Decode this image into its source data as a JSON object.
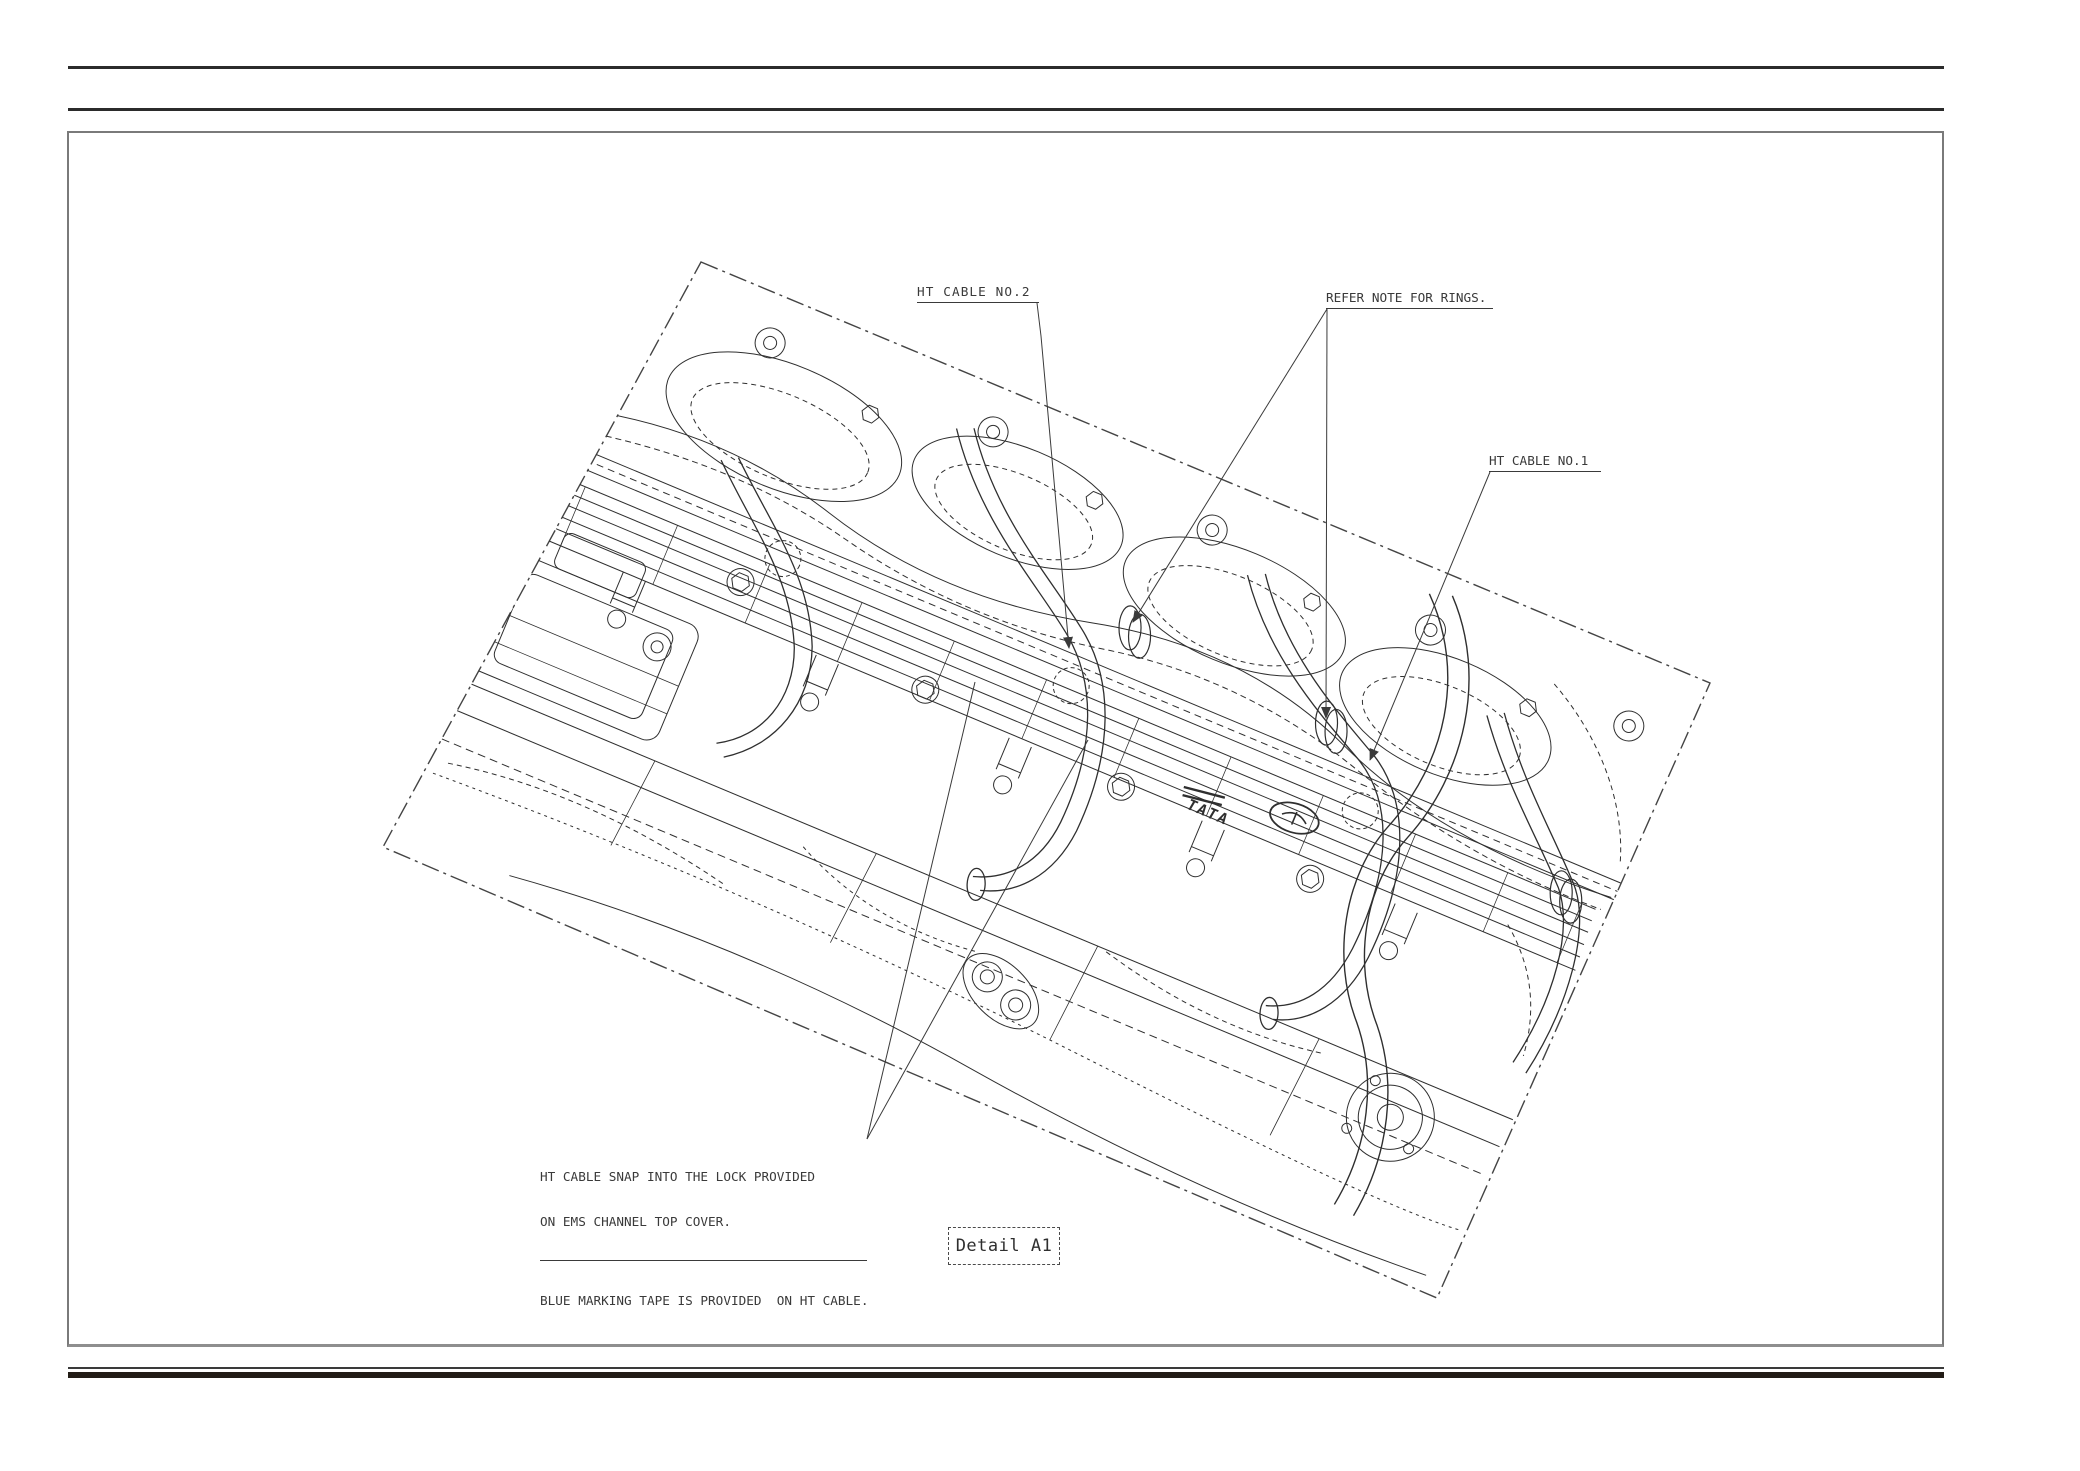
{
  "drawing": {
    "callouts": {
      "ht_cable_no2": "HT CABLE NO.2",
      "refer_note_rings": "REFER NOTE FOR RINGS.",
      "ht_cable_no1": "HT CABLE NO.1"
    },
    "note": {
      "line1": "HT CABLE SNAP INTO THE LOCK PROVIDED",
      "line2": "ON EMS CHANNEL TOP COVER.",
      "line3": "BLUE MARKING TAPE IS PROVIDED  ON HT CABLE."
    },
    "detail_label": "Detail A1",
    "engine_logo": "TATA",
    "colors": {
      "line": "#2f2f2f",
      "leader": "#3a3a3a",
      "border": "#7a7a7a",
      "rule": "#2b2b2b",
      "background": "#ffffff"
    }
  }
}
